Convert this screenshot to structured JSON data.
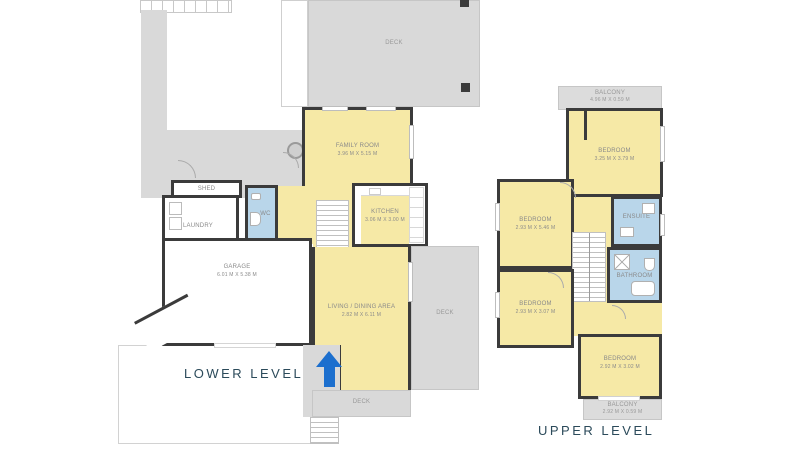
{
  "lower": {
    "title": "LOWER LEVEL",
    "deck_top_label": "DECK",
    "deck_right_label": "DECK",
    "deck_bottom_label": "DECK",
    "family": {
      "label": "FAMILY ROOM",
      "dims": "3.96 M X 5.15 M"
    },
    "kitchen": {
      "label": "KITCHEN",
      "dims": "3.06 M X 3.00 M"
    },
    "living": {
      "label": "LIVING / DINING AREA",
      "dims": "2.82 M X 6.11 M"
    },
    "garage": {
      "label": "GARAGE",
      "dims": "6.01 M X 5.38 M"
    },
    "laundry_label": "LAUNDRY",
    "shed_label": "SHED",
    "wc_label": "WC"
  },
  "upper": {
    "title": "UPPER LEVEL",
    "balcony_top": {
      "label": "BALCONY",
      "dims": "4.96 M X 0.59 M"
    },
    "balcony_bottom": {
      "label": "BALCONY",
      "dims": "2.92 M X 0.59 M"
    },
    "bedroom_top": {
      "label": "BEDROOM",
      "dims": "3.25 M X 3.79 M"
    },
    "bedroom_mid_left": {
      "label": "BEDROOM",
      "dims": "2.93 M X 5.46 M"
    },
    "bedroom_bottom_left": {
      "label": "BEDROOM",
      "dims": "2.93 M X 3.07 M"
    },
    "bedroom_bottom_right": {
      "label": "BEDROOM",
      "dims": "2.92 M X 3.02 M"
    },
    "ensuite_label": "ENSUITE",
    "bathroom_label": "BATHROOM"
  },
  "colors": {
    "room_fill": "#F6E9A6",
    "wet_room_fill": "#B9D6EA",
    "outdoor_fill": "#D9D9D9",
    "wall": "#3B3B3B",
    "entry_arrow": "#1C6FCE",
    "title_text": "#2B4A5A",
    "label_text": "#8A8A8A"
  }
}
